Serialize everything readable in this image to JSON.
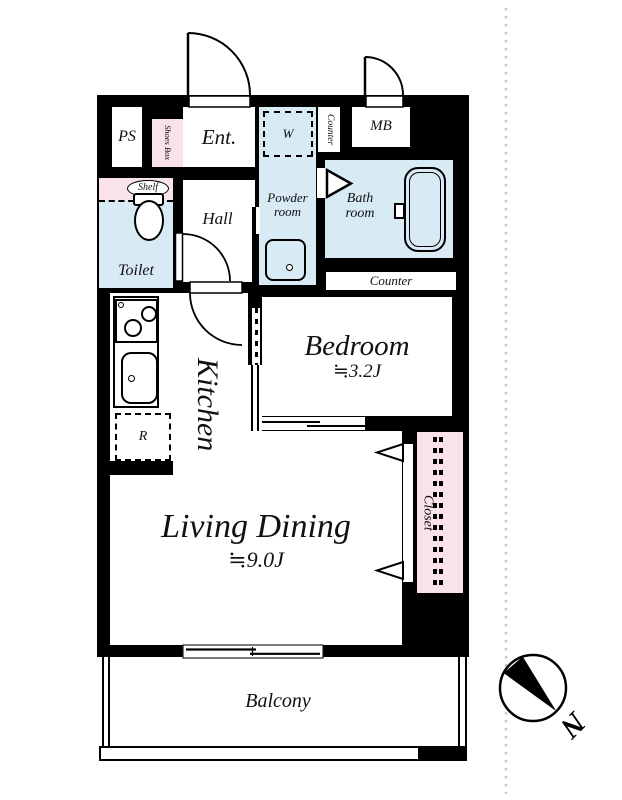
{
  "plan": {
    "rooms": {
      "ps": "PS",
      "shoes_box": "Shoes Box",
      "entrance": "Ent.",
      "washer": "W",
      "counter_upper": "Counter",
      "meter_box": "MB",
      "shelf": "Shelf",
      "toilet": "Toilet",
      "hall": "Hall",
      "powder_room": "Powder room",
      "bath_room": "Bath room",
      "counter_kitchen": "Counter",
      "kitchen": "Kitchen",
      "refrigerator": "R",
      "bedroom": "Bedroom",
      "bedroom_size": "≒3.2J",
      "living_dining": "Living Dining",
      "living_dining_size": "≒9.0J",
      "closet": "Closet",
      "balcony": "Balcony"
    },
    "compass": {
      "north": "N"
    },
    "colors": {
      "wall": "#000000",
      "wet_room_fill": "#d8eaf4",
      "storage_fill": "#f9e2ea",
      "boundary_dots": "#c9c9c9"
    }
  }
}
